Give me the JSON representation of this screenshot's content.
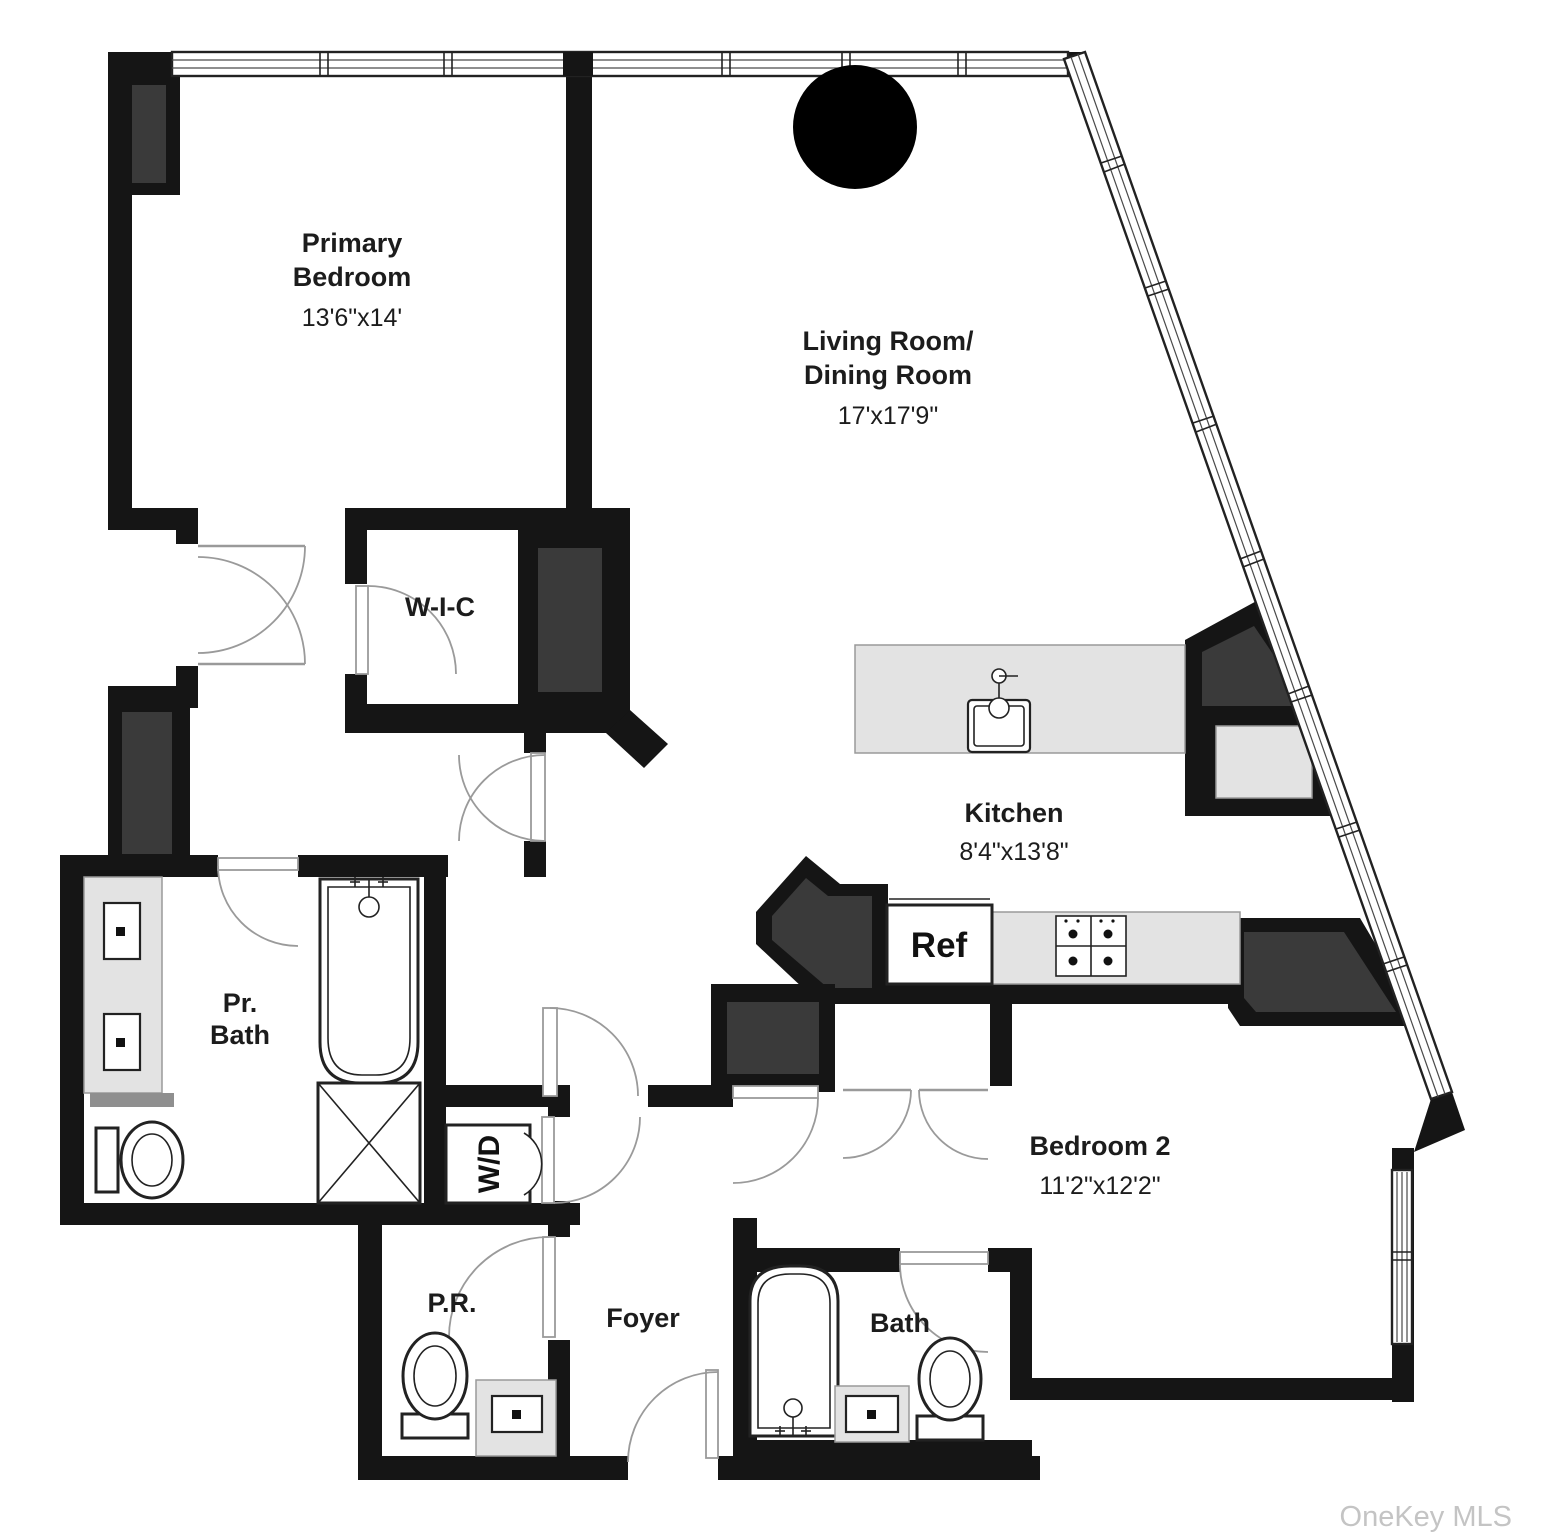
{
  "title": "Apartment floor plan",
  "colors": {
    "wall": "#151515",
    "chase": "#3a3a3a",
    "counter": "#e3e3e3",
    "counter_border": "#9a9a9a",
    "line": "#222222",
    "door": "#9a9a9a",
    "window_line": "#4a4a4a",
    "bar": "#8f8f8f",
    "watermark": "#c4c4c4"
  },
  "rooms": {
    "primary_bedroom": {
      "name_line1": "Primary",
      "name_line2": "Bedroom",
      "dimensions": "13'6\"x14'"
    },
    "living_dining": {
      "name_line1": "Living Room/",
      "name_line2": "Dining Room",
      "dimensions": "17'x17'9\""
    },
    "wic": {
      "name": "W-I-C"
    },
    "kitchen": {
      "name": "Kitchen",
      "dimensions": "8'4\"x13'8\""
    },
    "primary_bath": {
      "name_line1": "Pr.",
      "name_line2": "Bath"
    },
    "bedroom2": {
      "name": "Bedroom 2",
      "dimensions": "11'2\"x12'2\""
    },
    "powder_room": {
      "name": "P.R."
    },
    "foyer": {
      "name": "Foyer"
    },
    "bath2": {
      "name": "Bath"
    }
  },
  "appliances": {
    "refrigerator": "Ref",
    "washer_dryer": "W/D"
  },
  "watermark": "OneKey MLS"
}
